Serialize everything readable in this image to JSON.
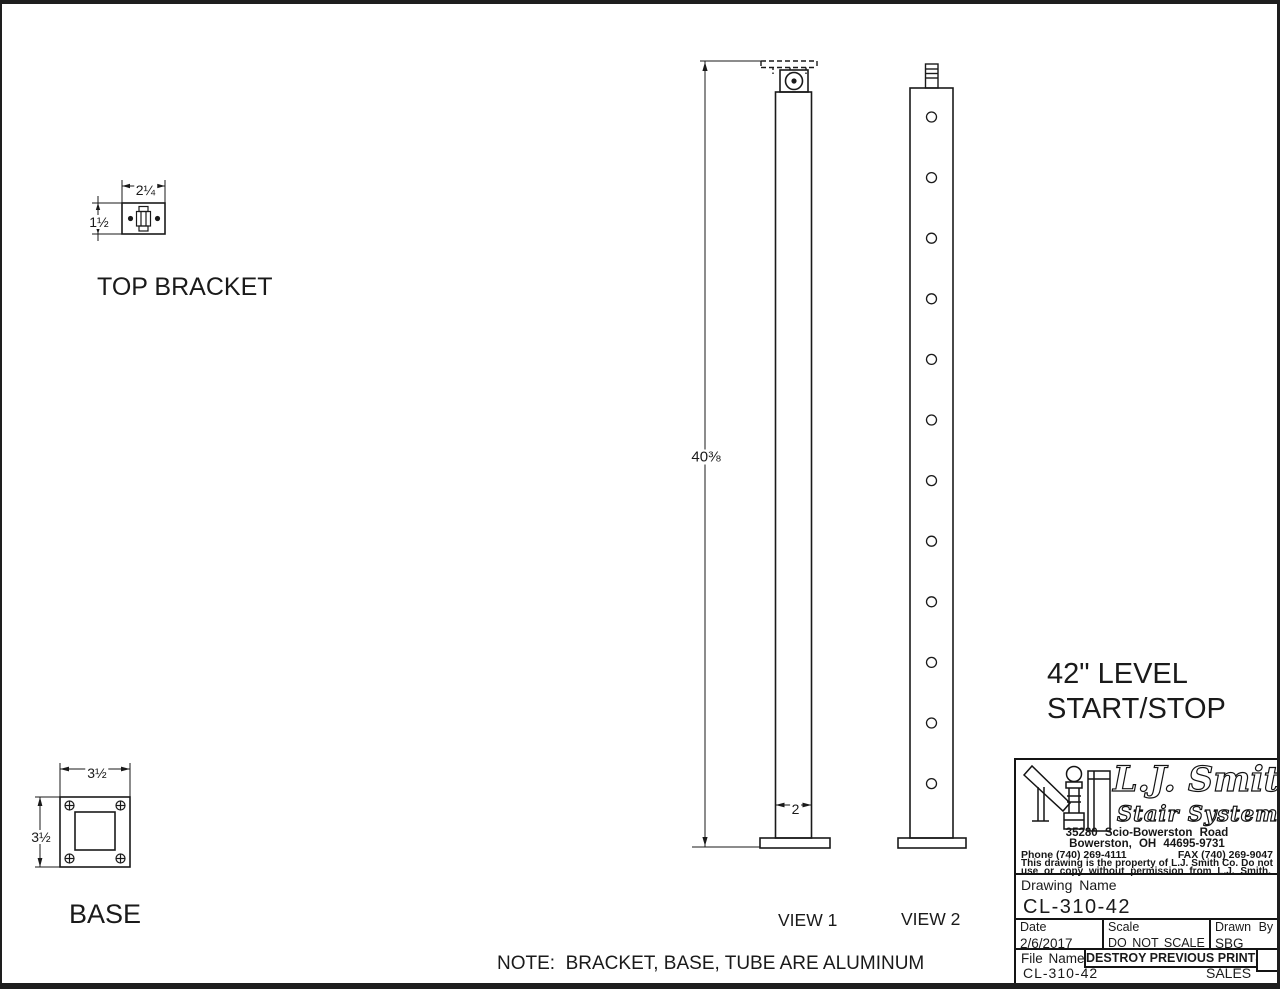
{
  "page": {
    "background": "#ffffff",
    "line_color": "#1a1a1a"
  },
  "details": {
    "top_bracket": {
      "label": "TOP BRACKET",
      "width_dim": "2¼",
      "height_dim": "1½"
    },
    "base": {
      "label": "BASE",
      "width_dim": "3½",
      "height_dim": "3½"
    }
  },
  "views": {
    "view1": {
      "label": "VIEW 1",
      "height_dim": "40⅜",
      "width_dim": "2"
    },
    "view2": {
      "label": "VIEW 2",
      "hole_count": 12
    }
  },
  "callout": {
    "line1": "42\" LEVEL",
    "line2": "START/STOP"
  },
  "note": "NOTE:  BRACKET, BASE, TUBE ARE ALUMINUM",
  "title_block": {
    "logo": {
      "name_script": "L.J. Smith",
      "subtitle": "Stair Systems"
    },
    "address_line1": "35280 Scio-Bowerston Road",
    "address_line2": "Bowerston, OH 44695-9731",
    "phone": "Phone (740) 269-4111",
    "fax": "FAX (740) 269-9047",
    "disclaimer_line1": "This drawing is the property of L.J. Smith Co. Do not",
    "disclaimer_line2": "use or copy without permission from L.J. Smith.",
    "drawing_name_label": "Drawing Name",
    "drawing_name": "CL-310-42",
    "date_label": "Date",
    "date": "2/6/2017",
    "scale_label": "Scale",
    "scale": "DO NOT SCALE",
    "drawn_by_label": "Drawn By",
    "drawn_by": "SBG",
    "file_name_label": "File Name",
    "file_name": "CL-310-42",
    "destroy_notice": "DESTROY PREVIOUS PRINTS",
    "department": "SALES"
  }
}
